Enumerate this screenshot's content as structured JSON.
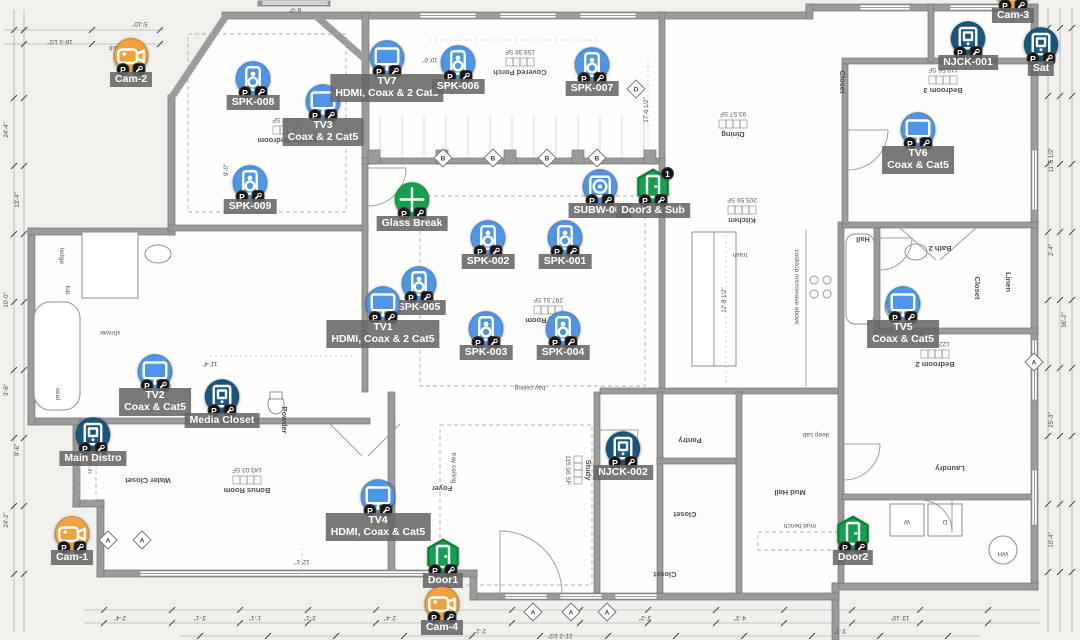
{
  "app": {
    "view": "floor-plan-device-layout"
  },
  "colors": {
    "av_blue": "#4d95e8",
    "camera_orange": "#f0a33c",
    "security_green": "#12a24f",
    "network_navy": "#17567f",
    "badge_black": "#151515",
    "label_bg": "#666666",
    "label_text": "#ffffff",
    "wall_gray": "#9b9b9b"
  },
  "badge_legend": {
    "left": "P",
    "right": "wrench-icon"
  },
  "devices": [
    {
      "id": "cam-2",
      "type": "camera",
      "x": 131,
      "y": 58,
      "lines": [
        "Cam-2"
      ]
    },
    {
      "id": "spk-008",
      "type": "speaker",
      "x": 253,
      "y": 81,
      "lines": [
        "SPK-008"
      ]
    },
    {
      "id": "tv3",
      "type": "tv",
      "x": 323,
      "y": 104,
      "lines": [
        "TV3",
        "Coax & 2 Cat5"
      ]
    },
    {
      "id": "tv7",
      "type": "tv",
      "x": 387,
      "y": 60,
      "lines": [
        "TV7",
        "HDMI, Coax & 2 Cat5"
      ]
    },
    {
      "id": "spk-006",
      "type": "speaker",
      "x": 458,
      "y": 65,
      "lines": [
        "SPK-006"
      ]
    },
    {
      "id": "spk-007",
      "type": "speaker",
      "x": 592,
      "y": 67,
      "lines": [
        "SPK-007"
      ]
    },
    {
      "id": "cam-3",
      "type": "camera",
      "x": 1013,
      "y": -6,
      "lines": [
        "Cam-3"
      ]
    },
    {
      "id": "njck-001",
      "type": "network",
      "x": 968,
      "y": 41,
      "lines": [
        "NJCK-001"
      ]
    },
    {
      "id": "sat",
      "type": "network",
      "x": 1041,
      "y": 47,
      "lines": [
        "Sat"
      ]
    },
    {
      "id": "tv6",
      "type": "tv",
      "x": 918,
      "y": 132,
      "lines": [
        "TV6",
        "Coax & Cat5"
      ]
    },
    {
      "id": "spk-009",
      "type": "speaker",
      "x": 250,
      "y": 185,
      "lines": [
        "SPK-009"
      ]
    },
    {
      "id": "glass-break",
      "type": "glassbreak",
      "x": 412,
      "y": 202,
      "lines": [
        "Glass Break"
      ]
    },
    {
      "id": "subw-002",
      "type": "subwoofer",
      "x": 600,
      "y": 189,
      "lines": [
        "SUBW-002"
      ]
    },
    {
      "id": "door3",
      "type": "door",
      "x": 653,
      "y": 189,
      "lines": [
        "Door3 & Sub"
      ],
      "count": "1"
    },
    {
      "id": "spk-002",
      "type": "speaker",
      "x": 488,
      "y": 240,
      "lines": [
        "SPK-002"
      ]
    },
    {
      "id": "spk-001",
      "type": "speaker",
      "x": 565,
      "y": 240,
      "lines": [
        "SPK-001"
      ]
    },
    {
      "id": "spk-005",
      "type": "speaker",
      "x": 419,
      "y": 286,
      "lines": [
        "SPK-005"
      ]
    },
    {
      "id": "tv1",
      "type": "tv",
      "x": 383,
      "y": 306,
      "lines": [
        "TV1",
        "HDMI, Coax & 2 Cat5"
      ]
    },
    {
      "id": "spk-003",
      "type": "speaker",
      "x": 486,
      "y": 331,
      "lines": [
        "SPK-003"
      ]
    },
    {
      "id": "spk-004",
      "type": "speaker",
      "x": 563,
      "y": 331,
      "lines": [
        "SPK-004"
      ]
    },
    {
      "id": "tv5",
      "type": "tv",
      "x": 903,
      "y": 306,
      "lines": [
        "TV5",
        "Coax & Cat5"
      ]
    },
    {
      "id": "tv2",
      "type": "tv",
      "x": 155,
      "y": 374,
      "lines": [
        "TV2",
        "Coax & Cat5"
      ]
    },
    {
      "id": "media-closet",
      "type": "network",
      "x": 222,
      "y": 399,
      "lines": [
        "Media Closet"
      ]
    },
    {
      "id": "main-distro",
      "type": "network",
      "x": 93,
      "y": 437,
      "lines": [
        "Main Distro"
      ]
    },
    {
      "id": "njck-002",
      "type": "network",
      "x": 623,
      "y": 451,
      "lines": [
        "NJCK-002"
      ]
    },
    {
      "id": "tv4",
      "type": "tv",
      "x": 378,
      "y": 499,
      "lines": [
        "TV4",
        "HDMI, Coax & Cat5"
      ]
    },
    {
      "id": "door1",
      "type": "door",
      "x": 443,
      "y": 559,
      "lines": [
        "Door1"
      ]
    },
    {
      "id": "cam-1",
      "type": "camera",
      "x": 72,
      "y": 536,
      "lines": [
        "Cam-1"
      ]
    },
    {
      "id": "cam-4",
      "type": "camera",
      "x": 442,
      "y": 606,
      "lines": [
        "Cam-4"
      ]
    },
    {
      "id": "door2",
      "type": "door",
      "x": 853,
      "y": 536,
      "lines": [
        "Door2"
      ]
    }
  ],
  "rooms": [
    {
      "name": "Covered Porch",
      "area": "159.38 SF",
      "x": 520,
      "y": 70,
      "rot": 180
    },
    {
      "name": "Master Bedroom",
      "area": "219.72 SF",
      "x": 287,
      "y": 138,
      "rot": 180
    },
    {
      "name": "Dining",
      "area": "93.57 SF",
      "x": 733,
      "y": 132,
      "rot": 180
    },
    {
      "name": "Kitchen",
      "area": "205.59 SF",
      "x": 742,
      "y": 218,
      "rot": 180
    },
    {
      "name": "Bedroom 3",
      "area": "119.56 SF",
      "x": 943,
      "y": 88,
      "rot": 180
    },
    {
      "name": "Living Room",
      "area": "297.51 SF",
      "x": 548,
      "y": 318,
      "rot": 180
    },
    {
      "name": "Bedroom 2",
      "area": "122.50 SF",
      "x": 935,
      "y": 362,
      "rot": 180
    },
    {
      "name": "Bath 2",
      "area": "",
      "x": 940,
      "y": 246,
      "rot": 180
    },
    {
      "name": "Study",
      "area": "115.96 SF",
      "x": 586,
      "y": 470,
      "rot": 90
    },
    {
      "name": "Foyer",
      "area": "",
      "x": 442,
      "y": 486,
      "rot": 180
    },
    {
      "name": "Bonus Room",
      "area": "143.03 SF",
      "x": 247,
      "y": 488,
      "rot": 180
    },
    {
      "name": "Pantry",
      "area": "",
      "x": 690,
      "y": 438,
      "rot": 180
    },
    {
      "name": "Closet",
      "area": "",
      "x": 685,
      "y": 512,
      "rot": 180
    },
    {
      "name": "Mud Hall",
      "area": "",
      "x": 790,
      "y": 490,
      "rot": 180
    },
    {
      "name": "Laundry",
      "area": "",
      "x": 950,
      "y": 466,
      "rot": 180
    },
    {
      "name": "Water Closet",
      "area": "",
      "x": 148,
      "y": 478,
      "rot": 180
    },
    {
      "name": "Powder",
      "area": "",
      "x": 282,
      "y": 420,
      "rot": 90
    },
    {
      "name": "Hall",
      "area": "",
      "x": 863,
      "y": 237,
      "rot": 180
    },
    {
      "name": "Closet",
      "area": "",
      "x": 840,
      "y": 82,
      "rot": 90
    },
    {
      "name": "Closet",
      "area": "",
      "x": 975,
      "y": 288,
      "rot": 90
    },
    {
      "name": "Linen",
      "area": "",
      "x": 1006,
      "y": 282,
      "rot": 90
    },
    {
      "name": "Closet",
      "area": "",
      "x": 665,
      "y": 572,
      "rot": 180
    }
  ],
  "annotations": [
    {
      "text": "vault",
      "x": 116,
      "y": 46,
      "rot": 180
    },
    {
      "text": "bay ceiling",
      "x": 530,
      "y": 386,
      "rot": 180
    },
    {
      "text": "tray ceiling",
      "x": 452,
      "y": 468,
      "rot": 90
    },
    {
      "text": "trash",
      "x": 740,
      "y": 253,
      "rot": 180
    },
    {
      "text": "cooktop microwave above",
      "x": 795,
      "y": 287,
      "rot": 90
    },
    {
      "text": "mud bench",
      "x": 800,
      "y": 524,
      "rot": 180
    },
    {
      "text": "deep cab",
      "x": 816,
      "y": 433,
      "rot": 180
    },
    {
      "text": "built-in",
      "x": 88,
      "y": 464,
      "rot": 90
    },
    {
      "text": "ledge",
      "x": 60,
      "y": 256,
      "rot": 90
    },
    {
      "text": "tub",
      "x": 66,
      "y": 290,
      "rot": 90
    },
    {
      "text": "shower",
      "x": 110,
      "y": 331,
      "rot": 180
    },
    {
      "text": "seat",
      "x": 56,
      "y": 394,
      "rot": 90
    },
    {
      "text": "W",
      "x": 907,
      "y": 520,
      "rot": 180
    },
    {
      "text": "D",
      "x": 945,
      "y": 520,
      "rot": 180
    },
    {
      "text": "WH",
      "x": 1003,
      "y": 552,
      "rot": 180
    }
  ],
  "window_tags": [
    {
      "letter": "B",
      "x": 443,
      "y": 158
    },
    {
      "letter": "B",
      "x": 493,
      "y": 158
    },
    {
      "letter": "B",
      "x": 547,
      "y": 158
    },
    {
      "letter": "B",
      "x": 597,
      "y": 158
    },
    {
      "letter": "D",
      "x": 636,
      "y": 89
    },
    {
      "letter": "A",
      "x": 533,
      "y": 612
    },
    {
      "letter": "A",
      "x": 571,
      "y": 612
    },
    {
      "letter": "A",
      "x": 607,
      "y": 612
    },
    {
      "letter": "A",
      "x": 108,
      "y": 540
    },
    {
      "letter": "A",
      "x": 142,
      "y": 540
    },
    {
      "letter": "A",
      "x": 1034,
      "y": 362
    }
  ],
  "dimensions": [
    {
      "text": "24'-4\"",
      "x": 8,
      "y": 130,
      "rot": -90
    },
    {
      "text": "10'-0\"",
      "x": 8,
      "y": 300,
      "rot": -90
    },
    {
      "text": "3'-6\"",
      "x": 8,
      "y": 390,
      "rot": -90
    },
    {
      "text": "24'-2\"",
      "x": 8,
      "y": 520,
      "rot": -90
    },
    {
      "text": "13'-4\"",
      "x": 19,
      "y": 200,
      "rot": -90
    },
    {
      "text": "9'-6\"",
      "x": 19,
      "y": 450,
      "rot": -90
    },
    {
      "text": "2'-8\"",
      "x": 1053,
      "y": 60,
      "rot": -90
    },
    {
      "text": "11'-5 1/2\"",
      "x": 1053,
      "y": 160,
      "rot": -90
    },
    {
      "text": "2'-4\"",
      "x": 1053,
      "y": 250,
      "rot": -90
    },
    {
      "text": "25'-3\"",
      "x": 1053,
      "y": 420,
      "rot": -90
    },
    {
      "text": "36'-2\"",
      "x": 1066,
      "y": 320,
      "rot": -90
    },
    {
      "text": "10'-4\"",
      "x": 1053,
      "y": 540,
      "rot": -90
    },
    {
      "text": "2'-4\"",
      "x": 120,
      "y": 616,
      "rot": 180
    },
    {
      "text": "3'-1\"",
      "x": 200,
      "y": 616,
      "rot": 180
    },
    {
      "text": "1'-1\"",
      "x": 255,
      "y": 616,
      "rot": 180
    },
    {
      "text": "3'-1\"",
      "x": 310,
      "y": 616,
      "rot": 180
    },
    {
      "text": "2'-4\"",
      "x": 390,
      "y": 616,
      "rot": 180
    },
    {
      "text": "2'-2\"",
      "x": 480,
      "y": 629,
      "rot": 180
    },
    {
      "text": "3'-2\"",
      "x": 645,
      "y": 616,
      "rot": 180
    },
    {
      "text": "4'-3\"",
      "x": 740,
      "y": 616,
      "rot": 180
    },
    {
      "text": "3'-7\"",
      "x": 840,
      "y": 629,
      "rot": 180
    },
    {
      "text": "21'-2 1/2\"",
      "x": 560,
      "y": 634,
      "rot": 180
    },
    {
      "text": "13'-10\"",
      "x": 900,
      "y": 616,
      "rot": 180
    },
    {
      "text": "6'-0\"",
      "x": 295,
      "y": 8,
      "rot": 180
    },
    {
      "text": "5'-10\"",
      "x": 140,
      "y": 22,
      "rot": 180
    },
    {
      "text": "16'-5 1/2\"",
      "x": 60,
      "y": 40,
      "rot": 180
    },
    {
      "text": "17'-6 1/2\"",
      "x": 648,
      "y": 110,
      "rot": -90
    },
    {
      "text": "12'-8 1/2\"",
      "x": 726,
      "y": 300,
      "rot": -90
    },
    {
      "text": "10'-0\"",
      "x": 430,
      "y": 58,
      "rot": 180
    },
    {
      "text": "9'-0\"",
      "x": 228,
      "y": 170,
      "rot": -90
    },
    {
      "text": "11'-4\"",
      "x": 210,
      "y": 362,
      "rot": 180
    },
    {
      "text": "12'-1\"",
      "x": 302,
      "y": 560,
      "rot": 180
    }
  ]
}
